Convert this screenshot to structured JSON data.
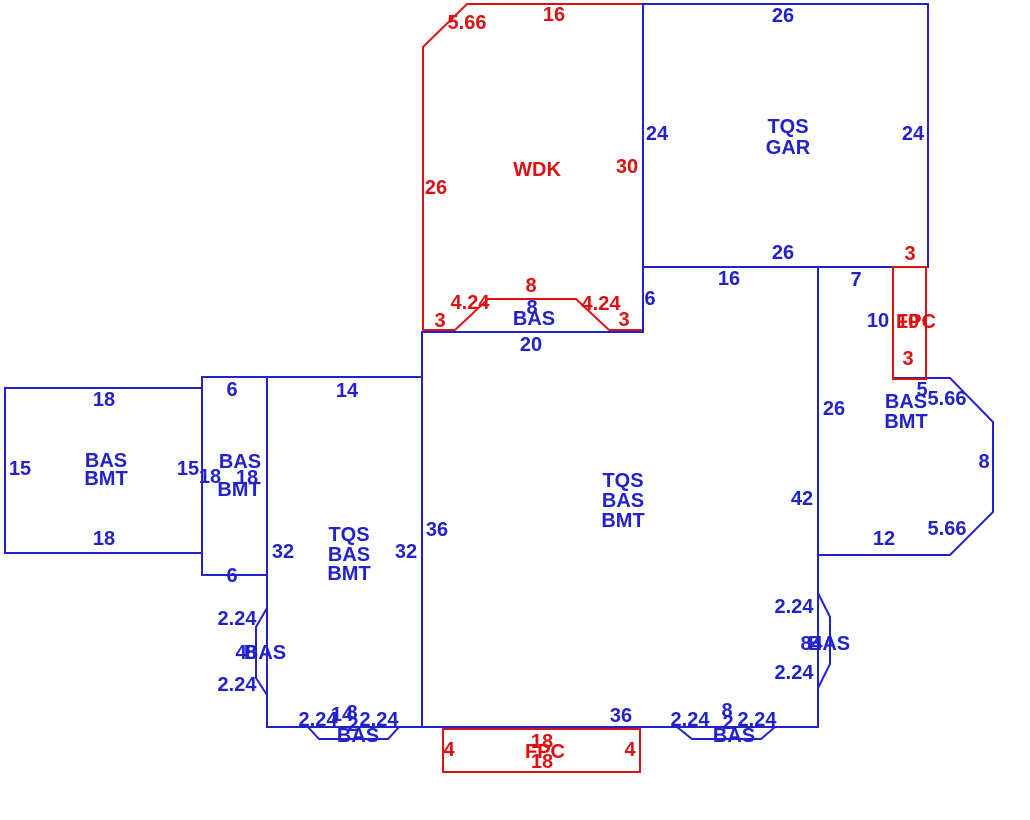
{
  "sketch_title": "floor-plan-sketch",
  "colors": {
    "blue": "#2222cc",
    "red": "#dd1111",
    "background": "#ffffff"
  },
  "regions": [
    {
      "name": "wdk-deck",
      "labels": [
        {
          "name": "wdk-dim-5-66",
          "text": "5.66",
          "color": "red",
          "x": 467,
          "y": 23
        },
        {
          "name": "wdk-dim-16",
          "text": "16",
          "color": "red",
          "x": 554,
          "y": 15
        },
        {
          "name": "wdk-dim-26",
          "text": "26",
          "color": "red",
          "x": 436,
          "y": 188
        },
        {
          "name": "wdk-dim-30",
          "text": "30",
          "color": "red",
          "x": 627,
          "y": 167
        },
        {
          "name": "wdk-area-label",
          "text": "WDK",
          "color": "red",
          "x": 537,
          "y": 170
        }
      ]
    },
    {
      "name": "garage",
      "labels": [
        {
          "name": "gar-dim-26-top",
          "text": "26",
          "color": "blue",
          "x": 783,
          "y": 16
        },
        {
          "name": "gar-dim-24-left",
          "text": "24",
          "color": "blue",
          "x": 657,
          "y": 134
        },
        {
          "name": "gar-dim-24-right",
          "text": "24",
          "color": "blue",
          "x": 913,
          "y": 134
        },
        {
          "name": "gar-area-label-line1",
          "text": "TQS",
          "color": "blue",
          "x": 788,
          "y": 127
        },
        {
          "name": "gar-area-label-line2",
          "text": "GAR",
          "color": "blue",
          "x": 788,
          "y": 148
        },
        {
          "name": "gar-dim-26-bottom",
          "text": "26",
          "color": "blue",
          "x": 783,
          "y": 253
        }
      ]
    },
    {
      "name": "top-bay",
      "labels": [
        {
          "name": "topbay-dim-8-red",
          "text": "8",
          "color": "red",
          "x": 531,
          "y": 286
        },
        {
          "name": "topbay-dim-4-24-left",
          "text": "4.24",
          "color": "red",
          "x": 470,
          "y": 303
        },
        {
          "name": "topbay-dim-4-24-right",
          "text": "4.24",
          "color": "red",
          "x": 601,
          "y": 304
        },
        {
          "name": "topbay-dim-3-left",
          "text": "3",
          "color": "red",
          "x": 440,
          "y": 321
        },
        {
          "name": "topbay-dim-3-right",
          "text": "3",
          "color": "red",
          "x": 624,
          "y": 320
        },
        {
          "name": "topbay-dim-8-blue",
          "text": "8",
          "color": "blue",
          "x": 532,
          "y": 308
        },
        {
          "name": "topbay-area-label",
          "text": "BAS",
          "color": "blue",
          "x": 534,
          "y": 319
        },
        {
          "name": "main-dim-20",
          "text": "20",
          "color": "blue",
          "x": 531,
          "y": 345
        }
      ]
    },
    {
      "name": "main-area",
      "labels": [
        {
          "name": "main-dim-6",
          "text": "6",
          "color": "blue",
          "x": 650,
          "y": 299
        },
        {
          "name": "main-dim-16",
          "text": "16",
          "color": "blue",
          "x": 729,
          "y": 279
        },
        {
          "name": "main-dim-7",
          "text": "7",
          "color": "blue",
          "x": 856,
          "y": 280
        },
        {
          "name": "main-area-label-line1",
          "text": "TQS",
          "color": "blue",
          "x": 623,
          "y": 481
        },
        {
          "name": "main-area-label-line2",
          "text": "BAS",
          "color": "blue",
          "x": 623,
          "y": 501
        },
        {
          "name": "main-area-label-line3",
          "text": "BMT",
          "color": "blue",
          "x": 623,
          "y": 521
        },
        {
          "name": "main-dim-36-left",
          "text": "36",
          "color": "blue",
          "x": 437,
          "y": 530
        },
        {
          "name": "main-dim-42",
          "text": "42",
          "color": "blue",
          "x": 802,
          "y": 499
        },
        {
          "name": "main-dim-36-bottom",
          "text": "36",
          "color": "blue",
          "x": 621,
          "y": 716
        }
      ]
    },
    {
      "name": "right-basement",
      "labels": [
        {
          "name": "right-dim-10",
          "text": "10",
          "color": "blue",
          "x": 878,
          "y": 321
        },
        {
          "name": "right-dim-5",
          "text": "5",
          "color": "blue",
          "x": 922,
          "y": 390
        },
        {
          "name": "right-dim-5-66-top",
          "text": "5.66",
          "color": "blue",
          "x": 947,
          "y": 399
        },
        {
          "name": "right-dim-8",
          "text": "8",
          "color": "blue",
          "x": 984,
          "y": 462
        },
        {
          "name": "right-dim-5-66-bottom",
          "text": "5.66",
          "color": "blue",
          "x": 947,
          "y": 529
        },
        {
          "name": "right-dim-12",
          "text": "12",
          "color": "blue",
          "x": 884,
          "y": 539
        },
        {
          "name": "right-dim-26",
          "text": "26",
          "color": "blue",
          "x": 834,
          "y": 409
        },
        {
          "name": "right-area-label-line1",
          "text": "BAS",
          "color": "blue",
          "x": 906,
          "y": 402
        },
        {
          "name": "right-area-label-line2",
          "text": "BMT",
          "color": "blue",
          "x": 906,
          "y": 422
        }
      ]
    },
    {
      "name": "left-basement",
      "labels": [
        {
          "name": "left-dim-18-top",
          "text": "18",
          "color": "blue",
          "x": 104,
          "y": 400
        },
        {
          "name": "left-dim-15-left",
          "text": "15",
          "color": "blue",
          "x": 20,
          "y": 469
        },
        {
          "name": "left-area-label-line1",
          "text": "BAS",
          "color": "blue",
          "x": 106,
          "y": 461
        },
        {
          "name": "left-area-label-line2",
          "text": "BMT",
          "color": "blue",
          "x": 106,
          "y": 479
        },
        {
          "name": "left-dim-15-right",
          "text": "15",
          "color": "blue",
          "x": 188,
          "y": 469
        },
        {
          "name": "left-dim-18-bottom",
          "text": "18",
          "color": "blue",
          "x": 104,
          "y": 539
        }
      ]
    },
    {
      "name": "narrow-basement",
      "labels": [
        {
          "name": "narrow-dim-6-top",
          "text": "6",
          "color": "blue",
          "x": 232,
          "y": 390
        },
        {
          "name": "narrow-area-label-line1",
          "text": "BAS",
          "color": "blue",
          "x": 240,
          "y": 462
        },
        {
          "name": "narrow-dim-18-left",
          "text": "18",
          "color": "blue",
          "x": 210,
          "y": 477
        },
        {
          "name": "narrow-dim-18-right",
          "text": "18",
          "color": "blue",
          "x": 247,
          "y": 478
        },
        {
          "name": "narrow-area-label-line2",
          "text": "BMT",
          "color": "blue",
          "x": 239,
          "y": 490
        },
        {
          "name": "narrow-dim-6-bottom",
          "text": "6",
          "color": "blue",
          "x": 232,
          "y": 576
        }
      ]
    },
    {
      "name": "mid-left-area",
      "labels": [
        {
          "name": "mid-dim-14",
          "text": "14",
          "color": "blue",
          "x": 347,
          "y": 391
        },
        {
          "name": "mid-dim-32-left",
          "text": "32",
          "color": "blue",
          "x": 283,
          "y": 552
        },
        {
          "name": "mid-area-label-line1",
          "text": "TQS",
          "color": "blue",
          "x": 349,
          "y": 535
        },
        {
          "name": "mid-area-label-line2",
          "text": "BAS",
          "color": "blue",
          "x": 349,
          "y": 555
        },
        {
          "name": "mid-area-label-line3",
          "text": "BMT",
          "color": "blue",
          "x": 349,
          "y": 574
        },
        {
          "name": "mid-dim-32-right",
          "text": "32",
          "color": "blue",
          "x": 406,
          "y": 552
        }
      ]
    },
    {
      "name": "left-bay",
      "labels": [
        {
          "name": "leftbay-dim-2-24-top",
          "text": "2.24",
          "color": "blue",
          "x": 237,
          "y": 619
        },
        {
          "name": "leftbay-dim-4",
          "text": "4",
          "color": "blue",
          "x": 241,
          "y": 653
        },
        {
          "name": "leftbay-dim-8",
          "text": "8",
          "color": "blue",
          "x": 251,
          "y": 653
        },
        {
          "name": "leftbay-area-label",
          "text": "BAS",
          "color": "blue",
          "x": 265,
          "y": 653
        },
        {
          "name": "leftbay-dim-2-24-bottom",
          "text": "2.24",
          "color": "blue",
          "x": 237,
          "y": 685
        }
      ]
    },
    {
      "name": "right-bay",
      "labels": [
        {
          "name": "rightbay-dim-2-24-top",
          "text": "2.24",
          "color": "blue",
          "x": 794,
          "y": 607
        },
        {
          "name": "rightbay-dim-8",
          "text": "8",
          "color": "blue",
          "x": 806,
          "y": 644
        },
        {
          "name": "rightbay-dim-4",
          "text": "4",
          "color": "blue",
          "x": 817,
          "y": 644
        },
        {
          "name": "rightbay-area-label",
          "text": "BAS",
          "color": "blue",
          "x": 829,
          "y": 644
        },
        {
          "name": "rightbay-dim-2-24-bottom",
          "text": "2.24",
          "color": "blue",
          "x": 794,
          "y": 673
        }
      ]
    },
    {
      "name": "bottom-left-bay",
      "labels": [
        {
          "name": "blbay-dim-2-24-left",
          "text": "2.24",
          "color": "blue",
          "x": 318,
          "y": 720
        },
        {
          "name": "blbay-dim-14",
          "text": "14",
          "color": "blue",
          "x": 342,
          "y": 715
        },
        {
          "name": "blbay-dim-8",
          "text": "8",
          "color": "blue",
          "x": 352,
          "y": 713
        },
        {
          "name": "blbay-dim-2",
          "text": "2",
          "color": "blue",
          "x": 353,
          "y": 725
        },
        {
          "name": "blbay-dim-2-24-right",
          "text": "2.24",
          "color": "blue",
          "x": 379,
          "y": 720
        },
        {
          "name": "blbay-area-label",
          "text": "BAS",
          "color": "blue",
          "x": 358,
          "y": 736
        }
      ]
    },
    {
      "name": "bottom-right-bay",
      "labels": [
        {
          "name": "brbay-dim-2-24-left",
          "text": "2.24",
          "color": "blue",
          "x": 690,
          "y": 720
        },
        {
          "name": "brbay-dim-8",
          "text": "8",
          "color": "blue",
          "x": 727,
          "y": 711
        },
        {
          "name": "brbay-dim-2",
          "text": "2",
          "color": "blue",
          "x": 728,
          "y": 723
        },
        {
          "name": "brbay-dim-2-24-right",
          "text": "2.24",
          "color": "blue",
          "x": 757,
          "y": 720
        },
        {
          "name": "brbay-area-label",
          "text": "BAS",
          "color": "blue",
          "x": 734,
          "y": 736
        }
      ]
    },
    {
      "name": "fpc-right",
      "labels": [
        {
          "name": "fpcright-dim-3-top",
          "text": "3",
          "color": "red",
          "x": 910,
          "y": 254
        },
        {
          "name": "fpcright-dim-10",
          "text": "10",
          "color": "red",
          "x": 908,
          "y": 322
        },
        {
          "name": "fpcright-area-label",
          "text": "FPC",
          "color": "red",
          "x": 916,
          "y": 322
        },
        {
          "name": "fpcright-dim-3-bottom",
          "text": "3",
          "color": "red",
          "x": 908,
          "y": 359
        }
      ]
    },
    {
      "name": "fpc-bottom",
      "labels": [
        {
          "name": "fpcbottom-dim-4-left",
          "text": "4",
          "color": "red",
          "x": 449,
          "y": 750
        },
        {
          "name": "fpcbottom-dim-4-right",
          "text": "4",
          "color": "red",
          "x": 630,
          "y": 750
        },
        {
          "name": "fpcbottom-dim-18-top",
          "text": "18",
          "color": "red",
          "x": 542,
          "y": 742
        },
        {
          "name": "fpcbottom-area-label",
          "text": "FPC",
          "color": "red",
          "x": 545,
          "y": 752
        },
        {
          "name": "fpcbottom-dim-18-bottom",
          "text": "18",
          "color": "red",
          "x": 542,
          "y": 762
        }
      ]
    }
  ]
}
